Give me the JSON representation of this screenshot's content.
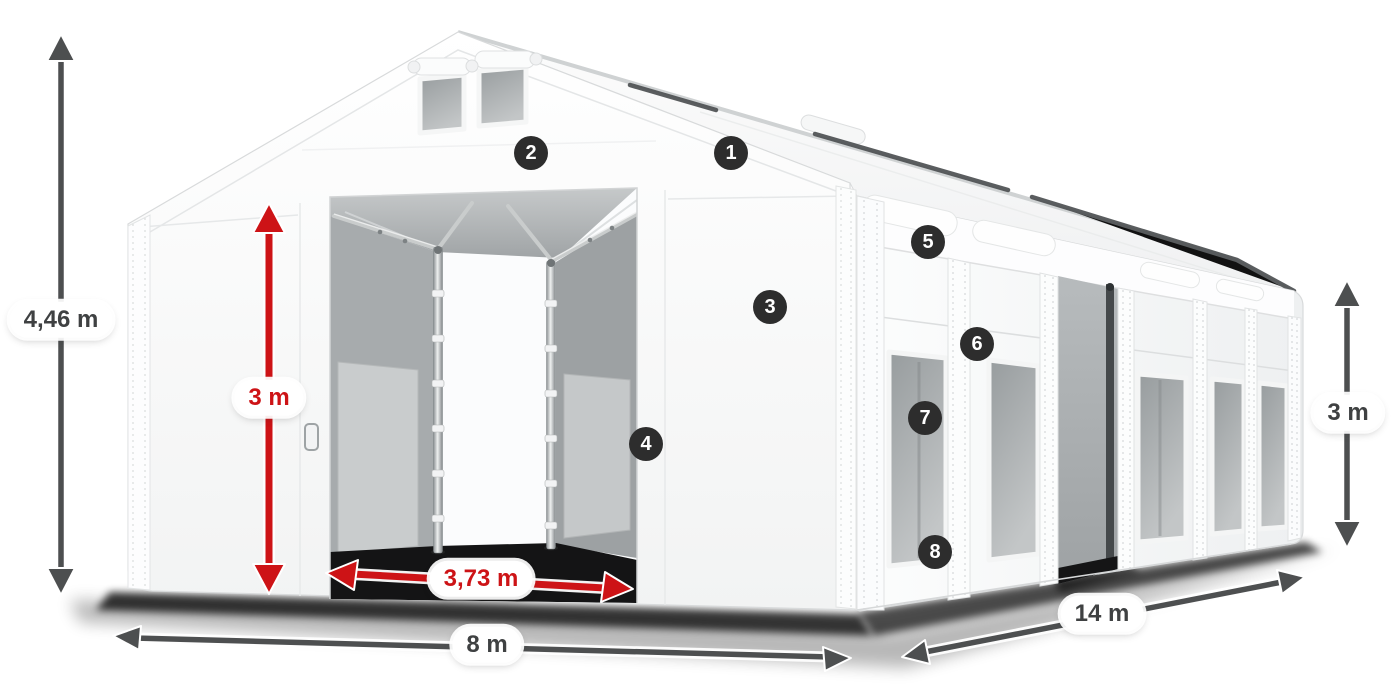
{
  "page": {
    "description": "Storage tent product diagram with dimension callouts and numbered feature hotspots"
  },
  "colors": {
    "background": "#ffffff",
    "dimension_red": "#cd1316",
    "dimension_gray": "#4d4f50",
    "marker_bg": "#2d2d2d",
    "marker_text": "#ffffff",
    "label_text": "#3f4142",
    "label_bg": "#ffffff"
  },
  "dimensions": {
    "total_height": {
      "label": "4,46 m"
    },
    "door_height": {
      "label": "3 m"
    },
    "door_width": {
      "label": "3,73 m"
    },
    "width": {
      "label": "8 m"
    },
    "length": {
      "label": "14 m"
    },
    "side_height": {
      "label": "3 m"
    }
  },
  "markers": [
    {
      "label": "1"
    },
    {
      "label": "2"
    },
    {
      "label": "3"
    },
    {
      "label": "4"
    },
    {
      "label": "5"
    },
    {
      "label": "6"
    },
    {
      "label": "7"
    },
    {
      "label": "8"
    }
  ]
}
